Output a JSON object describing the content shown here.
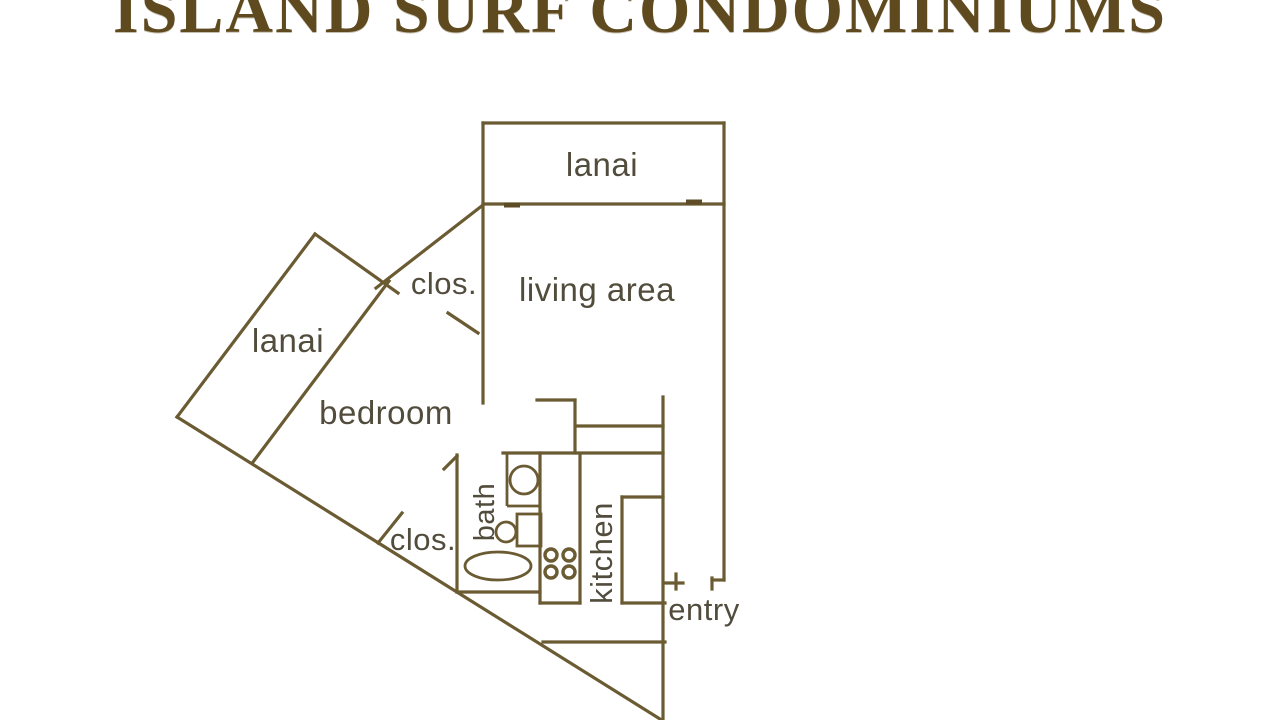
{
  "title": "ISLAND SURF CONDOMINIUMS",
  "rooms": {
    "lanai_top": "lanai",
    "living_area": "living area",
    "closet_upper": "clos.",
    "lanai_bedroom": "lanai",
    "bedroom": "bedroom",
    "closet_lower": "clos.",
    "bath": "bath",
    "kitchen": "kitchen",
    "entry": "entry"
  },
  "colors": {
    "background": "#ffffff",
    "wall_line": "#6b5b33",
    "room_label": "#514c3c",
    "title_text": "#5e4a1e"
  }
}
